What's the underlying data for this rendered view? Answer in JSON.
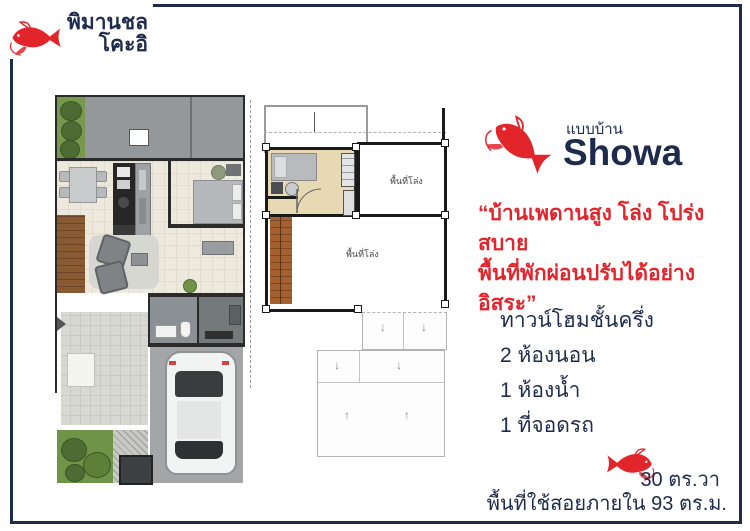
{
  "brand": {
    "logo_line1": "พิมานชล",
    "logo_line2": "โคะอิ"
  },
  "model": {
    "label": "แบบบ้าน",
    "name": "Showa"
  },
  "quote": {
    "line1": "“บ้านเพดานสูง โล่ง โปร่งสบาย",
    "line2": "พื้นที่พักผ่อนปรับได้อย่างอิสระ”"
  },
  "details": {
    "items": [
      "ทาวน์โฮมชั้นครึ่ง",
      "2 ห้องนอน",
      "1 ห้องน้ำ",
      "1 ที่จอดรถ"
    ]
  },
  "area": {
    "plot": "30 ตร.วา",
    "usable": "พื้นที่ใช้สอยภายใน 93 ตร.ม."
  },
  "floorplan": {
    "void_labels": [
      "พื้นที่โล่ง",
      "พื้นที่โล่ง"
    ]
  },
  "colors": {
    "navy": "#1e2b4c",
    "red": "#e2242b",
    "floor_cream": "#edeadd",
    "patio_gray": "#95989a",
    "garden_green": "#76994e",
    "wood_brown": "#8a5a33",
    "bedroom_tan": "#e7d9b4"
  }
}
